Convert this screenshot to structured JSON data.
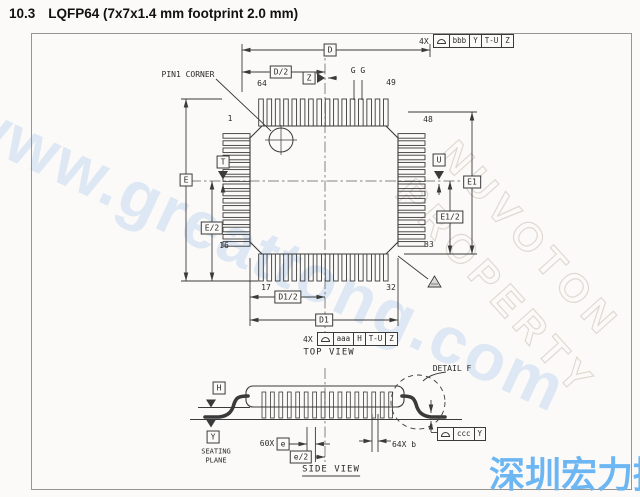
{
  "page": {
    "section_number": "10.3",
    "section_heading": "LQFP64 (7x7x1.4 mm footprint 2.0 mm)"
  },
  "watermarks": {
    "url_text": "www.greattong.com",
    "property_line1": "NUVOTON",
    "property_line2": "PROPERTY",
    "company_cn": "深圳宏力捷",
    "url_color": "#69a0e8",
    "company_color": "#6cb6f3",
    "emboss_color": "#beb2a2"
  },
  "icons": {
    "tolerance_symbol": "profile-of-surface",
    "note_flag": "hatched-triangle-flag",
    "pin1_marker": "circle-crosshair",
    "datum_marker": "filled-triangle"
  },
  "colors": {
    "line": "#3a3a3a"
  },
  "top_view": {
    "view_label": "TOP VIEW",
    "pin1_corner_label": "PIN1 CORNER",
    "pins": {
      "p1": "1",
      "p16": "16",
      "p17": "17",
      "p32": "32",
      "p33": "33",
      "p48": "48",
      "p49": "49",
      "p64": "64"
    },
    "dims": {
      "d": "D",
      "d_half": "D/2",
      "d1": "D1",
      "d1_half": "D1/2",
      "e": "E",
      "e_half": "E/2",
      "e1": "E1",
      "e1_half": "E1/2"
    },
    "datums": {
      "t": "T",
      "u": "U",
      "z": "Z"
    },
    "gauge_label": "G G",
    "tol_top": {
      "prefix": "4X",
      "tol": "bbb",
      "datum1": "Y",
      "datum2": "T-U",
      "datum3": "Z"
    },
    "tol_bottom": {
      "prefix": "4X",
      "tol": "aaa",
      "datum1": "H",
      "datum2": "T-U",
      "datum3": "Z"
    }
  },
  "side_view": {
    "view_label": "SIDE VIEW",
    "detail_label": "DETAIL F",
    "datums": {
      "h": "H",
      "y": "Y"
    },
    "seating_plane_line1": "SEATING",
    "seating_plane_line2": "PLANE",
    "pitch_count": "60X",
    "pitch_dim": "e",
    "pitch_half_dim": "e/2",
    "lead_width_label": "64X b",
    "tol": {
      "tol": "ccc",
      "datum1": "Y"
    }
  }
}
